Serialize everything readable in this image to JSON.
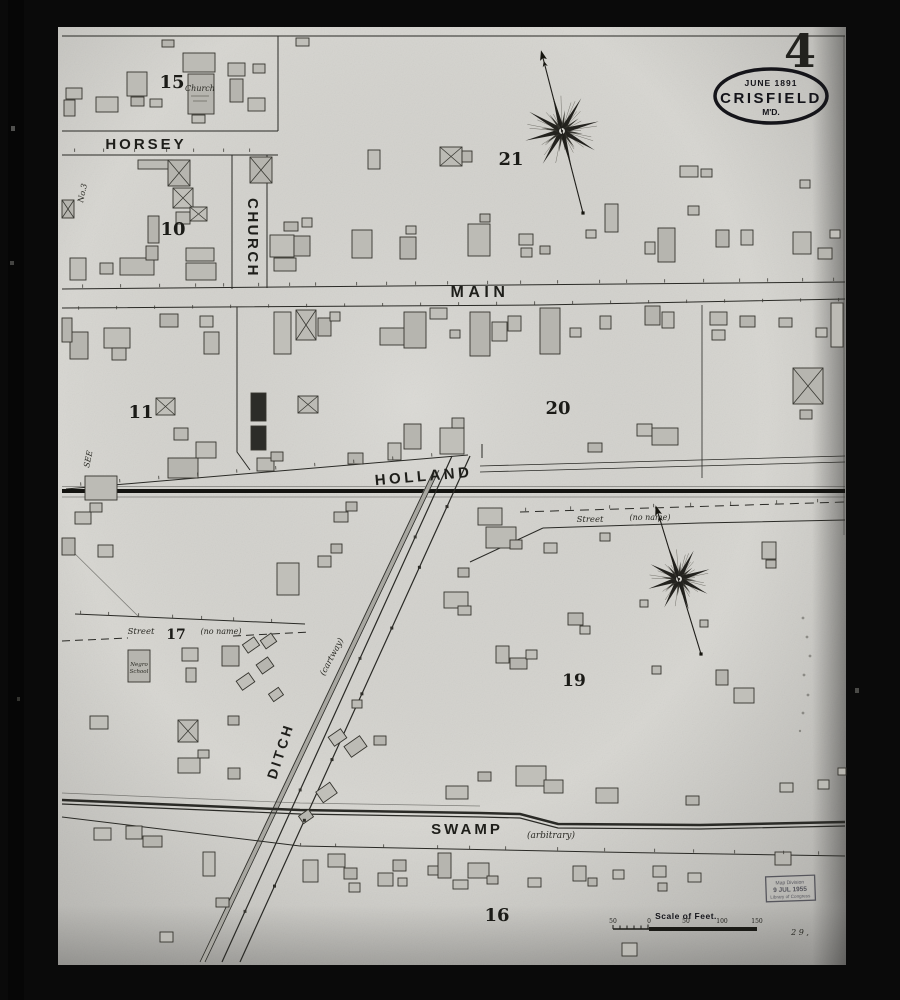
{
  "sheet": {
    "number": "4"
  },
  "title_stamp": {
    "date": "June 1891",
    "city": "CRISFIELD",
    "state": "M'D."
  },
  "streets": {
    "horsey": "HORSEY",
    "church": "CHURCH",
    "main": "MAIN",
    "holland": "HOLLAND",
    "swamp": "SWAMP",
    "ditch": "DITCH",
    "noname_right_label": "Street",
    "noname_right_paren": "(no name)",
    "noname_left_label": "Street",
    "noname_left_paren": "(no name)",
    "cartway": "(cartway)",
    "arbitrary": "(arbitrary)"
  },
  "blocks": {
    "b15": "15",
    "b10": "10",
    "b21": "21",
    "b11": "11",
    "b20": "20",
    "b17": "17",
    "b19": "19",
    "b16": "16"
  },
  "labels": {
    "no3": "No.3",
    "see": "SEE",
    "church_building": "Church",
    "negro_school_line1": "Negro",
    "negro_school_line2": "School",
    "pencil_note": "2 9 ,"
  },
  "scale_bar": {
    "title": "Scale of Feet.",
    "ticks": [
      "50",
      "0",
      "50",
      "100",
      "150"
    ]
  },
  "loc_stamp": {
    "line1": "Map Division",
    "line2": "9 JUL 1955",
    "line3": "Library of Congress"
  },
  "colors": {
    "paper": "#d7d6d1",
    "ink": "#2a2a26",
    "building_fill": "#b9b8b2",
    "building_dark": "#2c2c28"
  }
}
